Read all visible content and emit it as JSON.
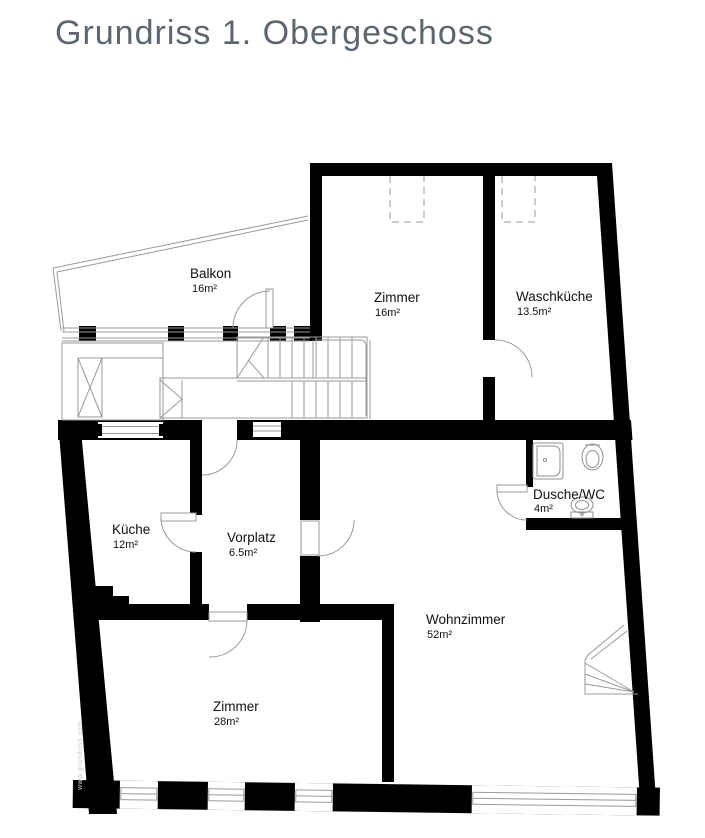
{
  "title": "Grundriss 1. Obergeschoss",
  "watermark": "www.grundriss.com",
  "rooms": [
    {
      "name": "Balkon",
      "area": "16m²"
    },
    {
      "name": "Zimmer",
      "area": "16m²"
    },
    {
      "name": "Waschküche",
      "area": "13.5m²"
    },
    {
      "name": "Küche",
      "area": "12m²"
    },
    {
      "name": "Vorplatz",
      "area": "6.5m²"
    },
    {
      "name": "Dusche/WC",
      "area": "4m²"
    },
    {
      "name": "Wohnzimmer",
      "area": "52m²"
    },
    {
      "name": "Zimmer",
      "area": "28m²"
    }
  ],
  "colors": {
    "wall": "#000000",
    "thin_line": "#9a9a9a",
    "title": "#5d6670",
    "label": "#111111",
    "background": "#ffffff",
    "watermark": "#c9c9c9"
  }
}
